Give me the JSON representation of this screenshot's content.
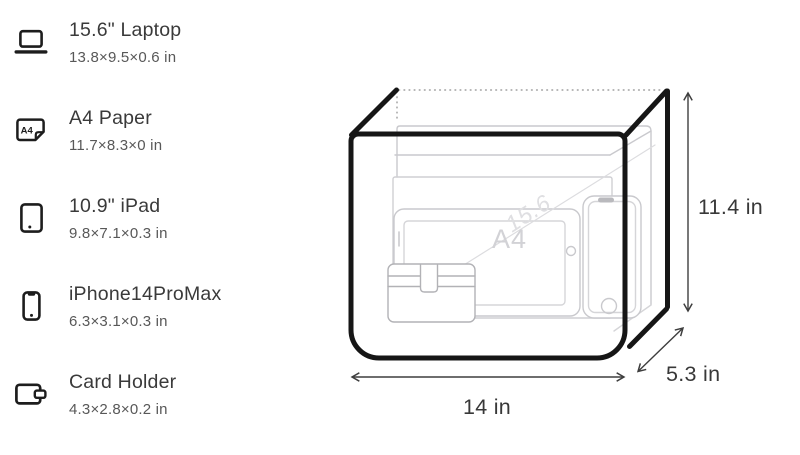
{
  "items": [
    {
      "name": "15.6\" Laptop",
      "dims": "13.8×9.5×0.6 in",
      "icon": "laptop-icon"
    },
    {
      "name": "A4 Paper",
      "dims": "11.7×8.3×0 in",
      "icon": "a4-paper-icon"
    },
    {
      "name": "10.9\" iPad",
      "dims": "9.8×7.1×0.3 in",
      "icon": "tablet-icon"
    },
    {
      "name": "iPhone14ProMax",
      "dims": "6.3×3.1×0.3 in",
      "icon": "phone-icon"
    },
    {
      "name": "Card Holder",
      "dims": "4.3×2.8×0.2 in",
      "icon": "wallet-icon"
    }
  ],
  "diagram": {
    "bag_dimensions": {
      "width": "14 in",
      "height": "11.4 in",
      "depth": "5.3 in"
    },
    "width_label": "14 in",
    "height_label": "11.4 in",
    "depth_label": "5.3 in",
    "watermark_a4": "A4",
    "watermark_laptop": "15.6"
  },
  "icon_text": {
    "a4": "A4"
  },
  "colors": {
    "ink": "#1d1d1d",
    "bag_outline": "#161616",
    "title_text": "#3a3a3a",
    "subtitle_text": "#585858",
    "ghost_outline": "#c9c9cd",
    "dimension_line": "#3e3e3e",
    "dotted_edge": "#ababab",
    "background": "#ffffff"
  }
}
